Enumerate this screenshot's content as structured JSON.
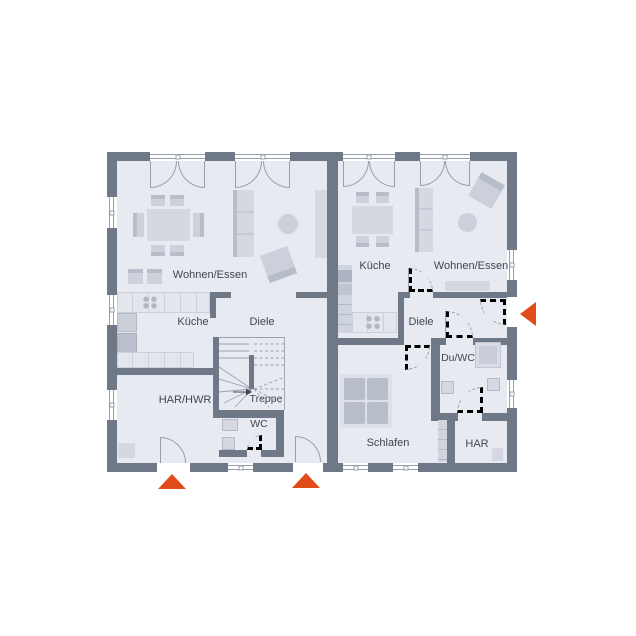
{
  "plan": {
    "type": "floor-plan",
    "colors": {
      "wall": "#6e7887",
      "floor": "#e8eaf1",
      "furniture": "#d5d8e1",
      "furniture_dark": "#b7bdc9",
      "counter": "#e3e6ec",
      "line": "#98a0ad",
      "accent": "#e04d1b",
      "label": "#3f4654"
    },
    "units": {
      "left": {
        "rooms": {
          "wohnen_essen": "Wohnen/Essen",
          "kueche": "Küche",
          "diele": "Diele",
          "har_hwr": "HAR/HWR",
          "treppe": "Treppe",
          "wc": "WC"
        }
      },
      "right": {
        "rooms": {
          "kueche": "Küche",
          "wohnen_essen": "Wohnen/Essen",
          "diele": "Diele",
          "du_wc": "Du/WC",
          "schlafen": "Schlafen",
          "har": "HAR"
        }
      }
    },
    "markers": {
      "entrance_left": "entrance-arrow-up",
      "entrance_center": "entrance-arrow-up",
      "entrance_right": "entrance-arrow-left"
    }
  }
}
